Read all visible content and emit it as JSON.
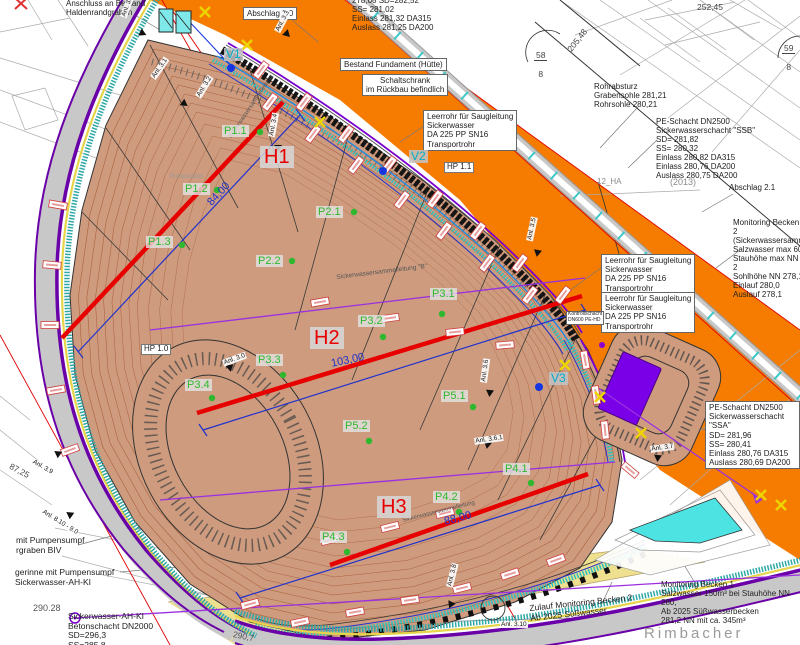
{
  "colors": {
    "orange_terrain": "#f57c00",
    "basin_fill": "#ce9b7e",
    "contour_brown": "#a8603c",
    "road_gray": "#c8c8c8",
    "band_purple": "#6a00a8",
    "yellow_road": "#eee08e",
    "drain_cyan": "#30c0c0",
    "profile_red": "#e60000",
    "point_green": "#2eb82e",
    "marker_blue": "#1535e0",
    "structure_violet": "#7a00e8",
    "pond_cyan": "#4de3e3"
  },
  "texts": {
    "anschluss": "Anschluss an Bestand\nHaldenrandgraben",
    "top_sd": "278,08  SD=282,52\nSS= 281,02\nEinlass  281,32 DA315\nAuslass 281,25 DA200",
    "abschlag20": "Abschlag 2.0",
    "bestand_fundament": "Bestand Fundament (Hütte)",
    "schaltschrank": "Schaltschrank\nim Rückbau befindlich",
    "leerrohr": "Leerrohr für Saugleitung\nSickerwasser\nDA 225 PP SN16\nTransportrohr",
    "rohrabsturz": "Rohrabsturz\nGrabensohle 281,21\nRohrsohle    280,21",
    "pe_ssb": "PE-Schacht DN2500\nSickerwasserschacht \"SSB\"\nSD= 281,82\nSS= 280,32\nEinlass  280,82 DA315\nEinlass  280,76 DA200\nAuslass 280,75 DA200",
    "pe_ssa": "PE-Schacht DN2500\nSickerwasserschacht \"SSA\"\nSD= 281,96\nSS= 280,41\nEinlass  280,76 DA315\nAuslass 280,69 DA200",
    "abschlag21": "Abschlag 2.1",
    "jahr": "(2013)",
    "ha": "12_HA",
    "monitoring2": "Monitoring Becken 2\n(Sickerwassersamm\nSalzwasser max 60\nStauhöhe max NN 2\nSohlhöhe NN 278,1\nEinlauf 280,0\nAuslauf 278,1",
    "monitoring1": "Monitoring Becken 1\nSalzwasser 150m³ bei Stauhöhe NN 280,\nAb 2025 Süßwasserbecken\n281,2 NN mit ca. 345m³",
    "zulauf": "Zulauf Monitoring Becken 2\nAb 2025 Süßwasser",
    "kontrollschacht": "Kontrollschacht\nDN600 PE-HD",
    "pumpensumpf": "mit Pumpensumpf\nrgraben BIV",
    "gerinne": "gerinne mit Pumpensumpf\nSickerwasser-AH-KI",
    "ahki": "Sickerwasser-AH-KI\nBetonschacht DN2000\nSD=296,3\nSS=285,8",
    "rimbacher": "Rimbacher",
    "sammel_b": "Sickerwassersammelleitung \"B\"",
    "sammel": "Sickerwassersammelleitung",
    "pumpstation": "Pumpstation"
  },
  "numbers": {
    "n25245": "252,45",
    "n20548": "205,48",
    "fr58": {
      "top": "58",
      "bot": "8"
    },
    "fr59": {
      "top": "59",
      "bot": "8"
    },
    "n29028": "290.28",
    "n2907": "290,7",
    "n8725": "87,25"
  },
  "profiles": [
    {
      "label": "H1",
      "dim": "84,00"
    },
    {
      "label": "H2",
      "dim": "103,00"
    },
    {
      "label": "H3",
      "dim": "88,00"
    }
  ],
  "points": [
    {
      "label": "P1.1"
    },
    {
      "label": "P1.2"
    },
    {
      "label": "P1.3"
    },
    {
      "label": "P2.1"
    },
    {
      "label": "P2.2"
    },
    {
      "label": "P3.1"
    },
    {
      "label": "P3.2"
    },
    {
      "label": "P3.3"
    },
    {
      "label": "P3.4"
    },
    {
      "label": "P5.1"
    },
    {
      "label": "P5.2"
    },
    {
      "label": "P4.1"
    },
    {
      "label": "P4.2"
    },
    {
      "label": "P4.3"
    }
  ],
  "v_points": [
    {
      "label": "V1"
    },
    {
      "label": "V2"
    },
    {
      "label": "V3"
    }
  ],
  "hp_points": [
    {
      "label": "HP 1.0"
    },
    {
      "label": "HP 1.1"
    }
  ],
  "anl_labels": [
    {
      "label": "Anl. 3.1"
    },
    {
      "label": "Anl. 3.1"
    },
    {
      "label": "Anl. 3.2"
    },
    {
      "label": "Anl. 3.3"
    },
    {
      "label": "Anl. 3.4"
    },
    {
      "label": "Anl. 3.5"
    },
    {
      "label": "Anl. 3.0"
    },
    {
      "label": "Anl. 3.6"
    },
    {
      "label": "Anl. 3.6.1"
    },
    {
      "label": "Anl. 3.7"
    },
    {
      "label": "Anl. 3.8"
    },
    {
      "label": "Anl. 3.9"
    },
    {
      "label": "Anl. 8.10 - 9.0"
    },
    {
      "label": "Anl. 3.10"
    }
  ]
}
